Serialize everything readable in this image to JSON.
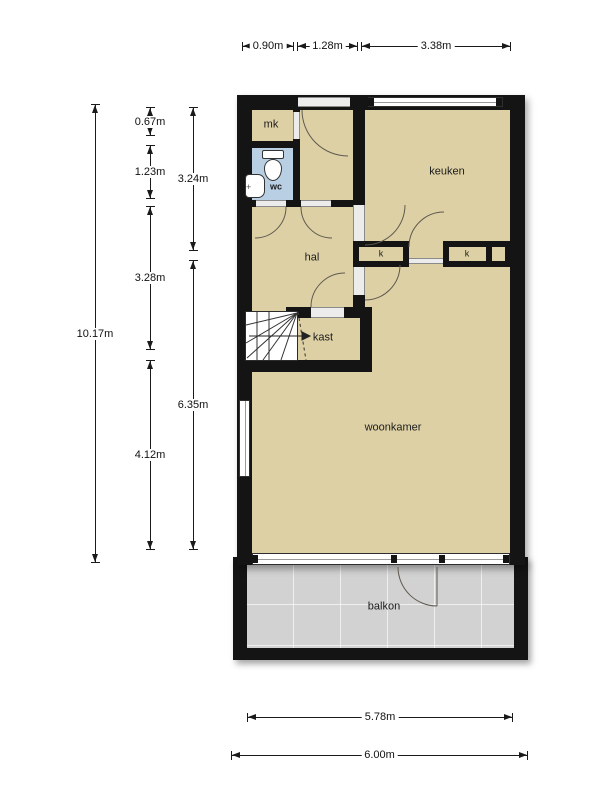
{
  "rooms": {
    "mk": "mk",
    "wc": "wc",
    "keuken": "keuken",
    "hal": "hal",
    "k1": "k",
    "k2": "k",
    "kast": "kast",
    "woonkamer": "woonkamer",
    "balkon": "balkon"
  },
  "dims": {
    "top_mk": "0.90m",
    "top_entry": "1.28m",
    "top_keuken": "3.38m",
    "left_total": "10.17m",
    "mk_height": "0.67m",
    "wc_height": "1.23m",
    "hal_height": "3.28m",
    "woonkamer_left": "4.12m",
    "keuken_height": "3.24m",
    "woonkamer_height": "6.35m",
    "bottom_inner": "5.78m",
    "bottom_outer": "6.00m"
  },
  "colors": {
    "floor": "#ddd0a5",
    "wc_floor": "#b9cfe3",
    "balcony_floor": "#d2d2d2",
    "wall": "#141414"
  }
}
